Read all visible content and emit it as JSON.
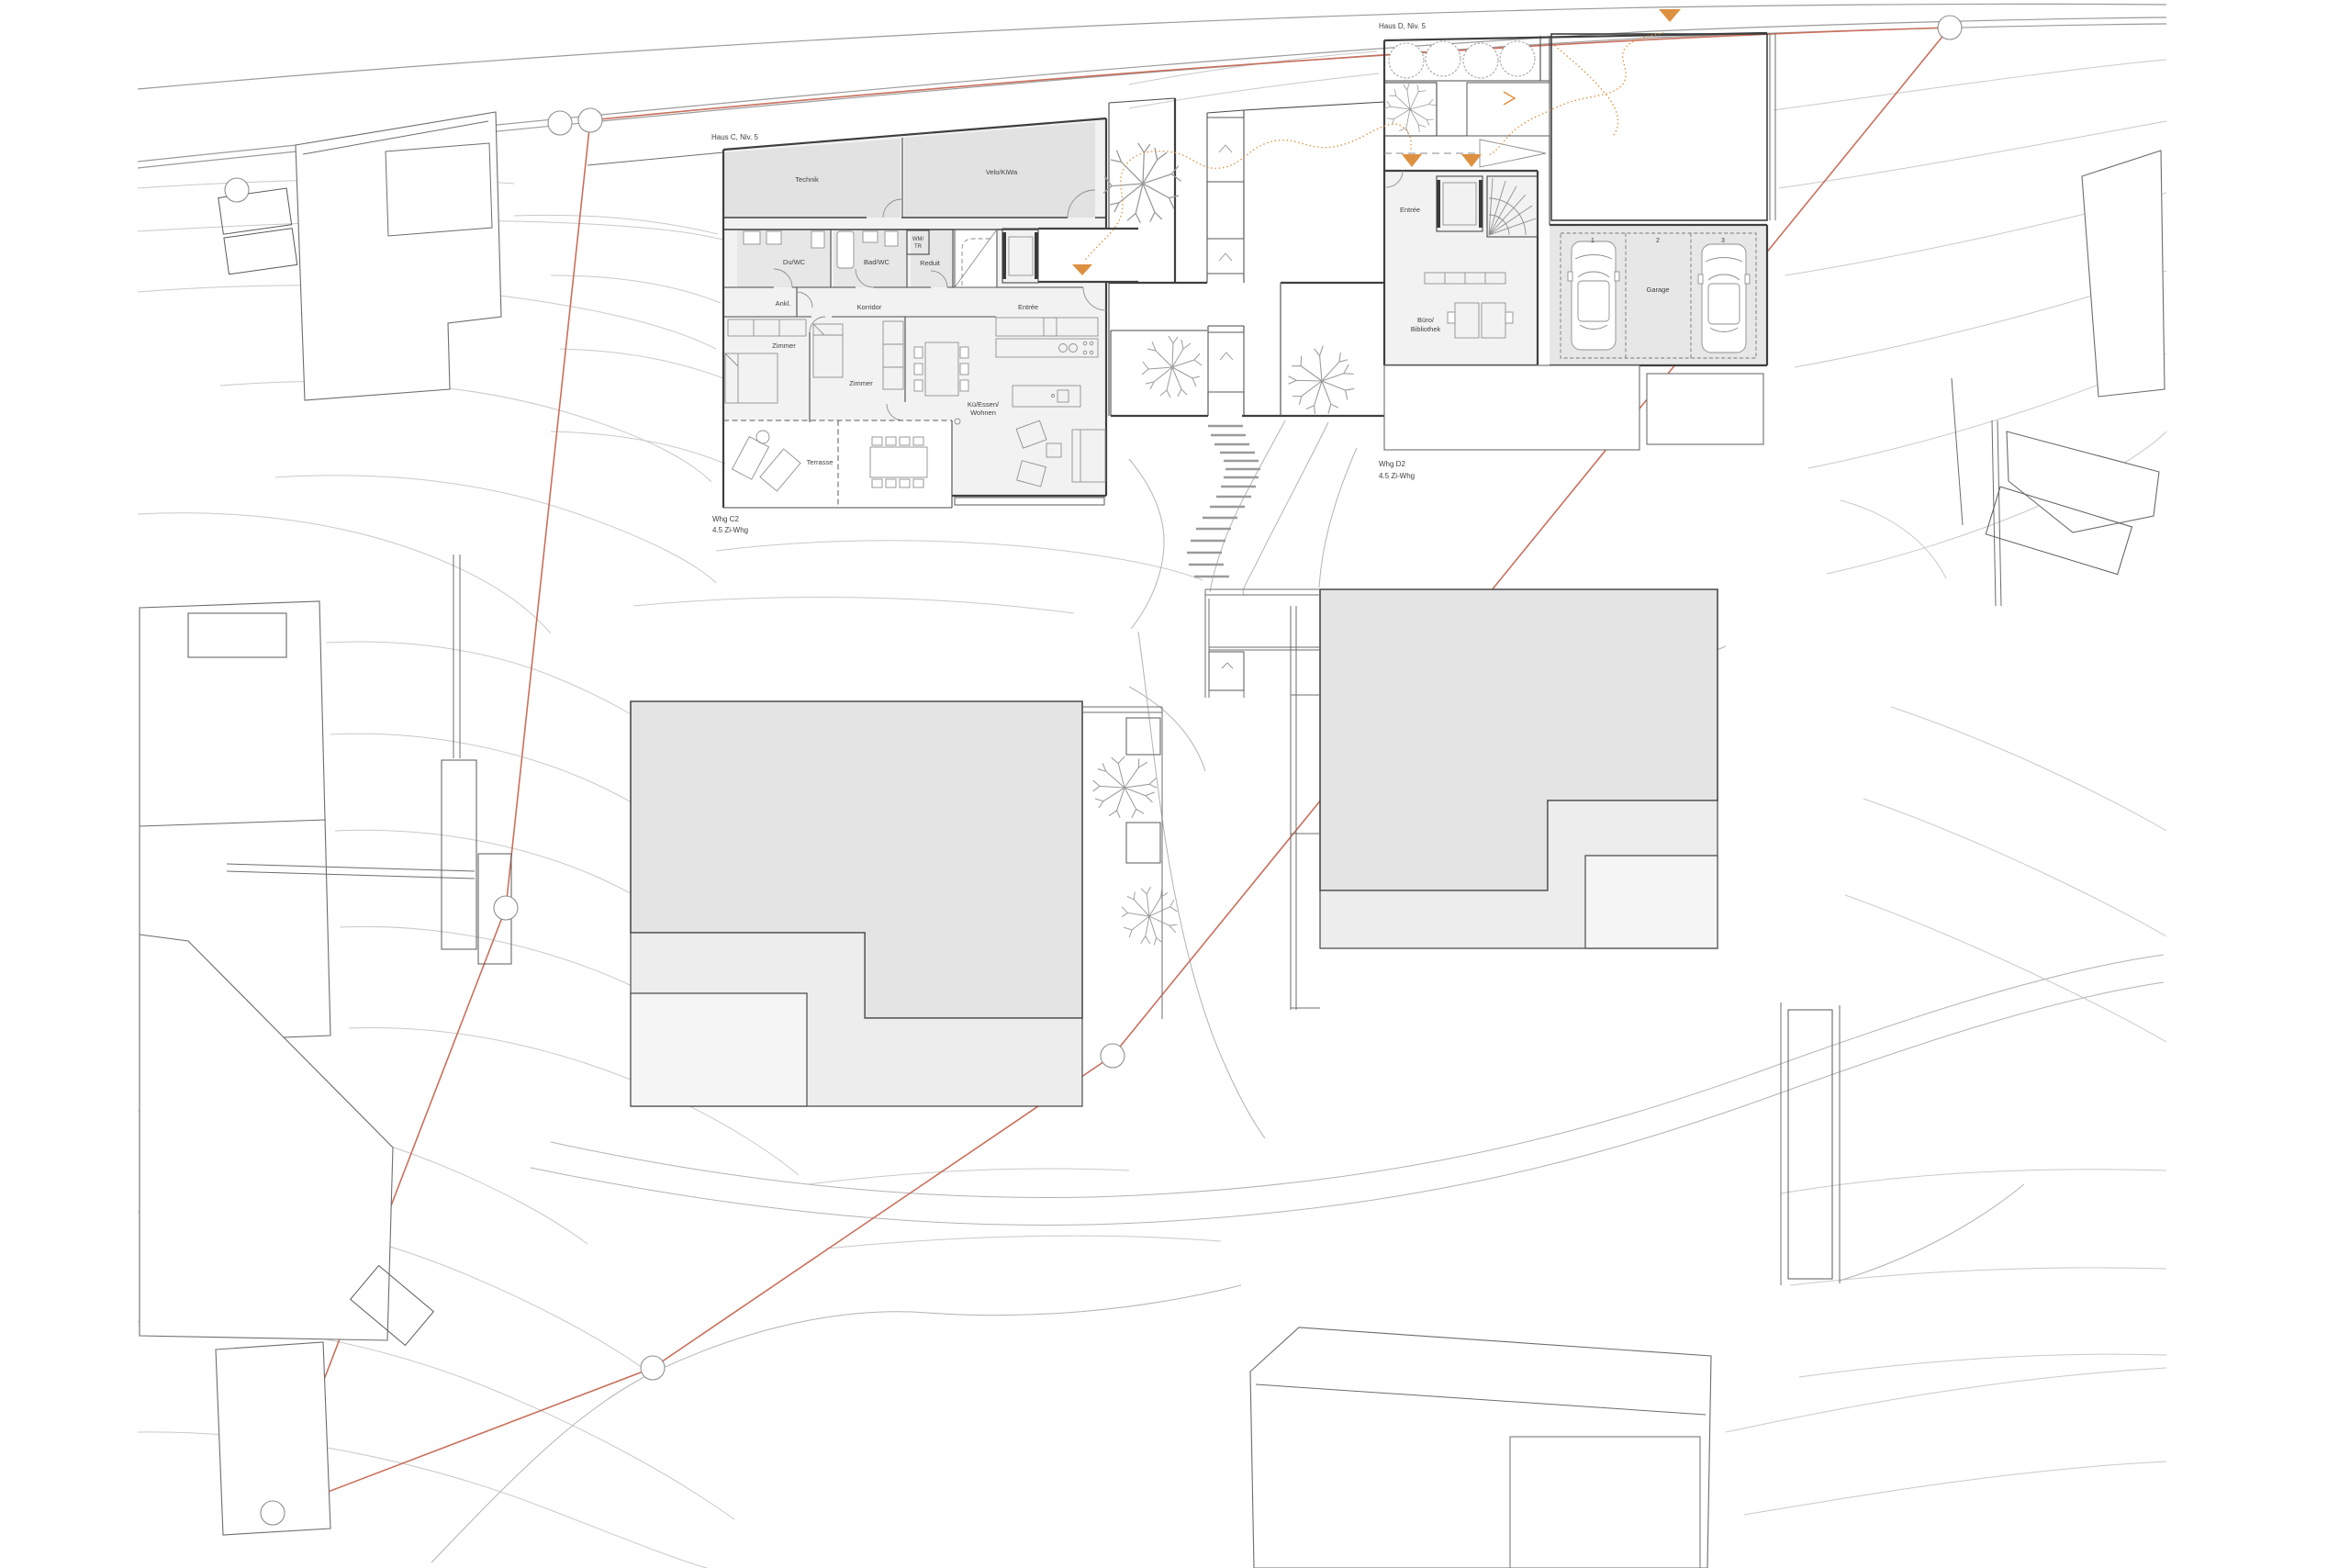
{
  "drawing": {
    "type": "architectural site plan",
    "colors": {
      "boundary_red": "#c9705c",
      "accent_orange": "#dd9040",
      "roof_gray": "#e4e4e5"
    }
  },
  "haus_c": {
    "label": "Haus C, Niv. 5",
    "whg": "Whg C2",
    "typ": "4.5 Zi-Whg",
    "rooms": {
      "technik": "Technik",
      "velo": "Velo/KiWa",
      "duwc": "Du/WC",
      "badwc": "Bad/WC",
      "wm": "WM/",
      "tr": "TR",
      "reduit": "Reduit",
      "ankl": "Ankl.",
      "korridor": "Korridor",
      "entree": "Entrée",
      "zimmer1": "Zimmer",
      "zimmer2": "Zimmer",
      "kue1": "Kü/Essen/",
      "kue2": "Wohnen",
      "terrasse": "Terrasse"
    }
  },
  "haus_d": {
    "label": "Haus D, Niv. 5",
    "whg": "Whg D2",
    "typ": "4.5 Zi-Whg",
    "rooms": {
      "entree": "Entrée",
      "buero1": "Büro/",
      "buero2": "Bibliothek",
      "garage": "Garage"
    },
    "spots": [
      "1",
      "2",
      "3"
    ]
  }
}
